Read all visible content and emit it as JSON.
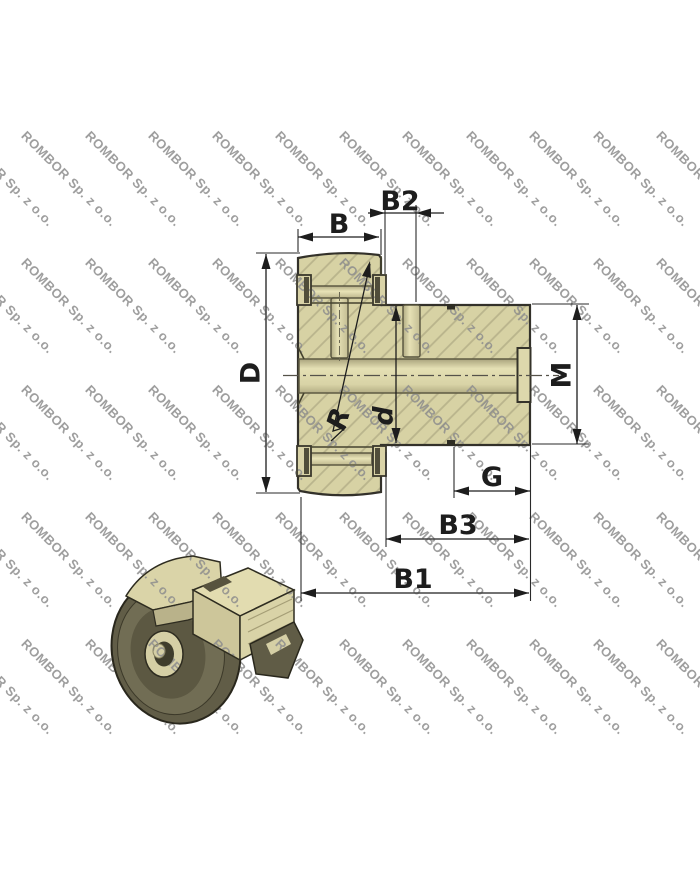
{
  "watermark": {
    "text": "ROMBOR Sp. z o.o.",
    "color": "#8e8e8e",
    "rows": 5,
    "cols": 12,
    "col_step": 63.5,
    "row_step": 127,
    "x_start": -34.5,
    "y_start": 128
  },
  "drawing": {
    "type": "cam-follower cross-section",
    "dimensions": [
      {
        "id": "B",
        "label": "B"
      },
      {
        "id": "B2",
        "label": "B2"
      },
      {
        "id": "D",
        "label": "D"
      },
      {
        "id": "M",
        "label": "M"
      },
      {
        "id": "R",
        "label": "R"
      },
      {
        "id": "d",
        "label": "d"
      },
      {
        "id": "G",
        "label": "G"
      },
      {
        "id": "B3",
        "label": "B3"
      },
      {
        "id": "B1",
        "label": "B1"
      }
    ],
    "colors": {
      "part_fill": "#d7d2a4",
      "part_light": "#ddd8ac",
      "hatch_line": "#b9b48c",
      "outline": "#33312a",
      "dimension": "#1d1d1d",
      "dark_detail": "#504d3a",
      "render_dark_olive": "#615d47",
      "render_cream": "#d9d3a7"
    }
  }
}
